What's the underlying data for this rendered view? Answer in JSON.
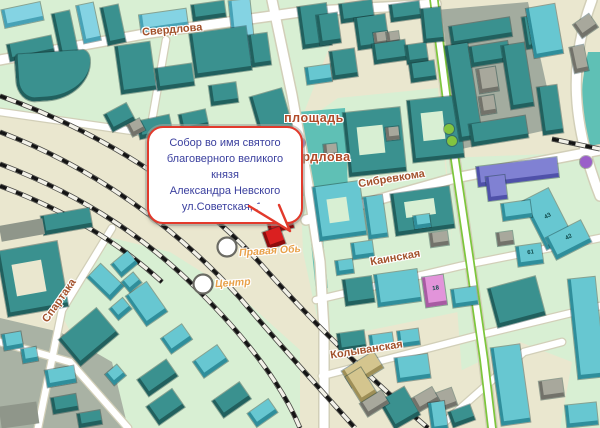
{
  "map": {
    "labels": {
      "street_sverdlova": "Свердлова",
      "square_line1": "площадь",
      "square_line2": "Свердлова",
      "street_sibrevkoma": "Сибревкома",
      "street_kainskaya": "Каинская",
      "street_kolyvanskaya": "Колыванская",
      "street_spartaka": "Спартака",
      "station_pravaya_ob": "Правая Обь",
      "station_centr": "Центр"
    },
    "callout": {
      "line1": "Собор во имя святого",
      "line2": "благоверного великого князя",
      "line3": "Александра Невского",
      "line4": "ул.Советская, 1а"
    },
    "colors": {
      "background": "#eae7cf",
      "green_zone": "#d8efd3",
      "gray_zone": "#a3ac9f",
      "gray_zone_sw": "#a9b2a4",
      "square_teal": "#5fc0b5",
      "road": "#ffffff",
      "road_casing": "#d2cfb8",
      "tree_line_green": "#7dc63c",
      "rail_dark": "#141414",
      "callout_border": "#e23a2c",
      "callout_text": "#3a3f9e",
      "street_label": "#a3522c",
      "station_label": "#e8a14a",
      "highlight_red": "#da2020"
    },
    "palette": {
      "teal": [
        "#3a918f",
        "#21605e"
      ],
      "cyan": [
        "#67c7d1",
        "#2f8e9b"
      ],
      "blue": [
        "#84d3e3",
        "#47a2b6"
      ],
      "gray": [
        "#a8a89c",
        "#72726a"
      ],
      "pink": [
        "#e294da",
        "#a75ba2"
      ],
      "violet": [
        "#8081d3",
        "#4f51a9"
      ],
      "khaki": [
        "#d4c58e",
        "#9e8f57"
      ],
      "red": [
        "#da2020",
        "#8c0d0d"
      ],
      "grayd": [
        "#8f968a"
      ],
      "cutG": [
        "#d8efd3"
      ],
      "cutB": [
        "#eae7cf"
      ]
    },
    "buildings": [
      [
        3,
        6,
        36,
        14,
        -12,
        "blue"
      ],
      [
        8,
        40,
        42,
        13,
        -12,
        "teal"
      ],
      [
        56,
        12,
        15,
        40,
        -12,
        "teal"
      ],
      [
        80,
        4,
        14,
        34,
        -12,
        "blue"
      ],
      [
        104,
        6,
        15,
        34,
        -12,
        "teal"
      ],
      [
        140,
        12,
        44,
        13,
        -8,
        "blue"
      ],
      [
        192,
        3,
        30,
        12,
        -8,
        "teal"
      ],
      [
        232,
        0,
        18,
        62,
        -6,
        "blue"
      ],
      [
        118,
        44,
        32,
        44,
        -8,
        "teal"
      ],
      [
        156,
        66,
        34,
        18,
        -8,
        "teal"
      ],
      [
        192,
        30,
        54,
        40,
        -8,
        "teal"
      ],
      [
        210,
        84,
        24,
        16,
        -8,
        "teal"
      ],
      [
        250,
        34,
        16,
        28,
        -8,
        "teal"
      ],
      [
        16,
        52,
        72,
        44,
        -4,
        "teal",
        null,
        "6% 12% 75% 30% / 16% 26% 98% 55%"
      ],
      [
        138,
        118,
        30,
        14,
        -12,
        "teal"
      ],
      [
        180,
        112,
        24,
        13,
        -12,
        "teal"
      ],
      [
        255,
        92,
        30,
        40,
        -16,
        "teal"
      ],
      [
        300,
        5,
        26,
        38,
        -8,
        "teal"
      ],
      [
        318,
        14,
        18,
        26,
        -8,
        "teal"
      ],
      [
        340,
        2,
        30,
        15,
        -8,
        "teal"
      ],
      [
        356,
        16,
        28,
        28,
        -8,
        "teal"
      ],
      [
        390,
        3,
        27,
        13,
        -8,
        "teal"
      ],
      [
        422,
        8,
        17,
        30,
        -6,
        "teal"
      ],
      [
        374,
        32,
        11,
        9,
        -8,
        "gray"
      ],
      [
        387,
        32,
        9,
        8,
        -8,
        "gray"
      ],
      [
        373,
        42,
        30,
        16,
        -8,
        "teal"
      ],
      [
        406,
        44,
        18,
        15,
        -8,
        "teal"
      ],
      [
        331,
        50,
        22,
        24,
        -8,
        "teal"
      ],
      [
        410,
        62,
        22,
        15,
        -8,
        "teal"
      ],
      [
        306,
        66,
        22,
        13,
        -8,
        "cyan"
      ],
      [
        346,
        110,
        54,
        60,
        -6,
        "teal"
      ],
      [
        358,
        126,
        26,
        28,
        -6,
        "cutG"
      ],
      [
        410,
        98,
        48,
        58,
        -6,
        "teal"
      ],
      [
        422,
        112,
        22,
        28,
        -6,
        "cutG"
      ],
      [
        386,
        127,
        10,
        9,
        -6,
        "gray"
      ],
      [
        324,
        144,
        10,
        9,
        -6,
        "gray"
      ],
      [
        316,
        184,
        44,
        50,
        -8,
        "cyan"
      ],
      [
        328,
        198,
        20,
        24,
        -8,
        "cutG"
      ],
      [
        366,
        196,
        16,
        38,
        -8,
        "cyan"
      ],
      [
        393,
        190,
        56,
        38,
        -8,
        "teal"
      ],
      [
        405,
        200,
        30,
        16,
        -8,
        "cutG"
      ],
      [
        430,
        232,
        15,
        10,
        -8,
        "gray"
      ],
      [
        414,
        215,
        13,
        9,
        -8,
        "cyan"
      ],
      [
        352,
        242,
        18,
        12,
        -8,
        "cyan"
      ],
      [
        336,
        260,
        14,
        10,
        -8,
        "cyan"
      ],
      [
        344,
        278,
        26,
        22,
        -8,
        "teal"
      ],
      [
        376,
        272,
        40,
        28,
        -8,
        "cyan"
      ],
      [
        424,
        276,
        18,
        26,
        -8,
        "pink",
        "18"
      ],
      [
        452,
        288,
        22,
        14,
        -8,
        "cyan"
      ],
      [
        338,
        332,
        24,
        14,
        -8,
        "teal"
      ],
      [
        370,
        334,
        20,
        12,
        -8,
        "cyan"
      ],
      [
        398,
        330,
        18,
        12,
        -8,
        "cyan"
      ],
      [
        450,
        22,
        58,
        15,
        -9,
        "teal"
      ],
      [
        452,
        44,
        20,
        92,
        -9,
        "teal"
      ],
      [
        470,
        44,
        36,
        16,
        -9,
        "teal"
      ],
      [
        506,
        44,
        20,
        60,
        -9,
        "teal"
      ],
      [
        470,
        120,
        54,
        18,
        -9,
        "teal"
      ],
      [
        478,
        68,
        16,
        20,
        -9,
        "gray"
      ],
      [
        480,
        96,
        12,
        14,
        -9,
        "gray"
      ],
      [
        524,
        16,
        15,
        28,
        -9,
        "teal"
      ],
      [
        530,
        6,
        26,
        46,
        -10,
        "cyan"
      ],
      [
        576,
        18,
        16,
        12,
        -35,
        "gray"
      ],
      [
        572,
        46,
        11,
        22,
        -12,
        "gray"
      ],
      [
        540,
        86,
        17,
        44,
        -8,
        "teal"
      ],
      [
        477,
        162,
        78,
        16,
        -7,
        "violet"
      ],
      [
        487,
        176,
        16,
        20,
        -7,
        "violet"
      ],
      [
        533,
        192,
        26,
        50,
        -27,
        "cyan",
        "43"
      ],
      [
        549,
        228,
        36,
        20,
        -27,
        "cyan",
        "42"
      ],
      [
        502,
        202,
        26,
        13,
        -8,
        "cyan"
      ],
      [
        517,
        245,
        22,
        16,
        -8,
        "cyan",
        "61"
      ],
      [
        497,
        232,
        13,
        9,
        -8,
        "gray"
      ],
      [
        492,
        282,
        46,
        36,
        -15,
        "teal"
      ],
      [
        496,
        346,
        26,
        74,
        -8,
        "cyan"
      ],
      [
        573,
        278,
        24,
        96,
        -6,
        "cyan"
      ],
      [
        566,
        404,
        28,
        18,
        -6,
        "cyan"
      ],
      [
        540,
        380,
        20,
        14,
        -8,
        "gray"
      ],
      [
        428,
        392,
        24,
        14,
        -20,
        "gray"
      ],
      [
        450,
        408,
        20,
        12,
        -20,
        "teal"
      ],
      [
        344,
        360,
        34,
        15,
        -32,
        "khaki"
      ],
      [
        352,
        370,
        15,
        26,
        -32,
        "khaki"
      ],
      [
        396,
        356,
        30,
        20,
        -8,
        "cyan"
      ],
      [
        385,
        392,
        26,
        28,
        -30,
        "teal"
      ],
      [
        414,
        392,
        20,
        11,
        -30,
        "gray"
      ],
      [
        362,
        396,
        22,
        11,
        -32,
        "gray"
      ],
      [
        430,
        402,
        13,
        24,
        -8,
        "cyan"
      ],
      [
        107,
        108,
        22,
        15,
        -28,
        "teal"
      ],
      [
        129,
        121,
        11,
        9,
        -28,
        "gray"
      ],
      [
        42,
        212,
        46,
        15,
        -10,
        "teal"
      ],
      [
        0,
        222,
        44,
        16,
        -10,
        "grayd"
      ],
      [
        2,
        246,
        58,
        62,
        -10,
        "teal"
      ],
      [
        14,
        262,
        30,
        32,
        -10,
        "cutB"
      ],
      [
        114,
        256,
        18,
        12,
        -40,
        "cyan"
      ],
      [
        96,
        266,
        16,
        28,
        -46,
        "cyan"
      ],
      [
        124,
        276,
        12,
        9,
        -40,
        "cyan"
      ],
      [
        134,
        286,
        22,
        32,
        -35,
        "cyan"
      ],
      [
        112,
        302,
        14,
        10,
        -40,
        "cyan"
      ],
      [
        64,
        320,
        46,
        30,
        -40,
        "teal"
      ],
      [
        108,
        368,
        12,
        10,
        -40,
        "cyan"
      ],
      [
        140,
        368,
        32,
        16,
        -35,
        "teal"
      ],
      [
        150,
        396,
        28,
        18,
        -35,
        "teal"
      ],
      [
        164,
        330,
        22,
        14,
        -35,
        "cyan"
      ],
      [
        196,
        352,
        26,
        15,
        -35,
        "cyan"
      ],
      [
        215,
        390,
        30,
        16,
        -35,
        "teal"
      ],
      [
        250,
        405,
        22,
        12,
        -35,
        "cyan"
      ],
      [
        3,
        333,
        16,
        12,
        -10,
        "cyan"
      ],
      [
        22,
        348,
        12,
        10,
        -10,
        "cyan"
      ],
      [
        46,
        368,
        26,
        13,
        -10,
        "cyan"
      ],
      [
        52,
        396,
        22,
        12,
        -10,
        "teal"
      ],
      [
        78,
        412,
        20,
        10,
        -10,
        "teal"
      ],
      [
        0,
        404,
        38,
        22,
        -8,
        "grayd"
      ],
      [
        266,
        203,
        22,
        24,
        -14,
        "red"
      ],
      [
        265,
        229,
        15,
        14,
        -20,
        "red"
      ]
    ],
    "dots": [
      {
        "x": 300,
        "y": 143,
        "r": 5,
        "c": "#9a5fc9",
        "name": "poi-dot-purple"
      },
      {
        "x": 586,
        "y": 162,
        "r": 6,
        "c": "#9a5fc9",
        "name": "poi-dot-purple"
      },
      {
        "x": 449,
        "y": 129,
        "r": 5,
        "c": "#83c43f",
        "name": "tree-dot-green"
      },
      {
        "x": 452,
        "y": 141,
        "r": 5,
        "c": "#83c43f",
        "name": "tree-dot-green"
      }
    ]
  }
}
